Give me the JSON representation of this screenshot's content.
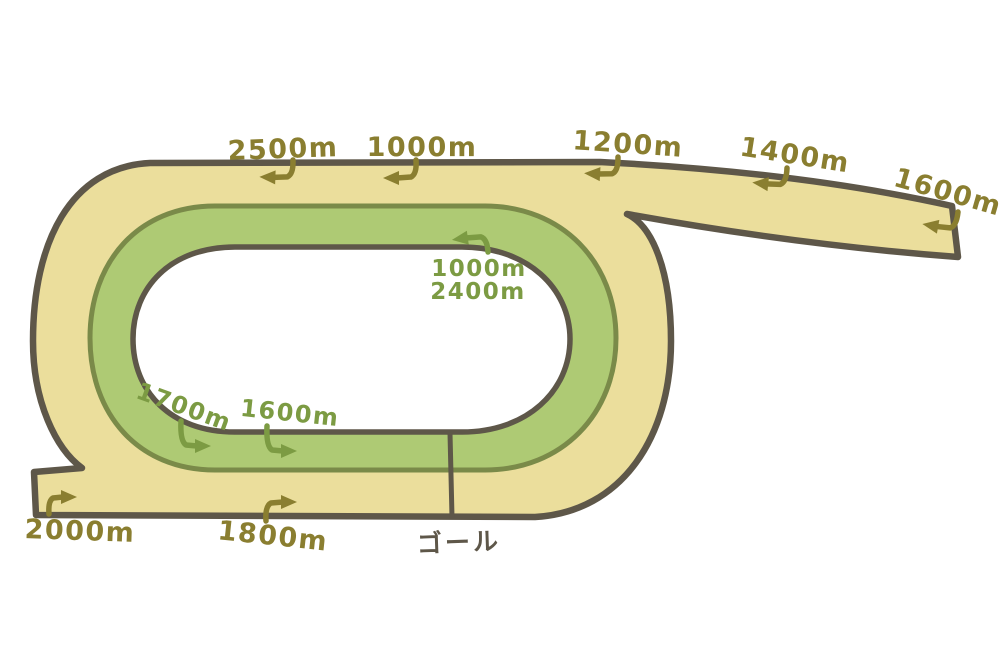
{
  "course": {
    "type": "racecourse-distance-diagram",
    "finish_label": "ゴール",
    "outer_markers": {
      "m2500": "2500m",
      "m1000": "1000m",
      "m1200": "1200m",
      "m1400": "1400m",
      "m1600": "1600m",
      "m1800": "1800m",
      "m2000": "2000m"
    },
    "inner_markers": {
      "m1000": "1000m",
      "m2400": "2400m",
      "m1700": "1700m",
      "m1600": "1600m"
    },
    "arrow_directions": {
      "top_markers": "left",
      "bottom_markers": "right",
      "inner_backstretch": "up-left"
    },
    "colors": {
      "dirt_track": "#EBDE9C",
      "turf_track": "#AECA74",
      "outline": "#5E5749",
      "turf_border": "#7A8A49",
      "infield": "#FFFFFF",
      "outer_label_color": "#8A7E30",
      "inner_label_color": "#7C9B43",
      "goal_label_color": "#5E5749"
    }
  }
}
